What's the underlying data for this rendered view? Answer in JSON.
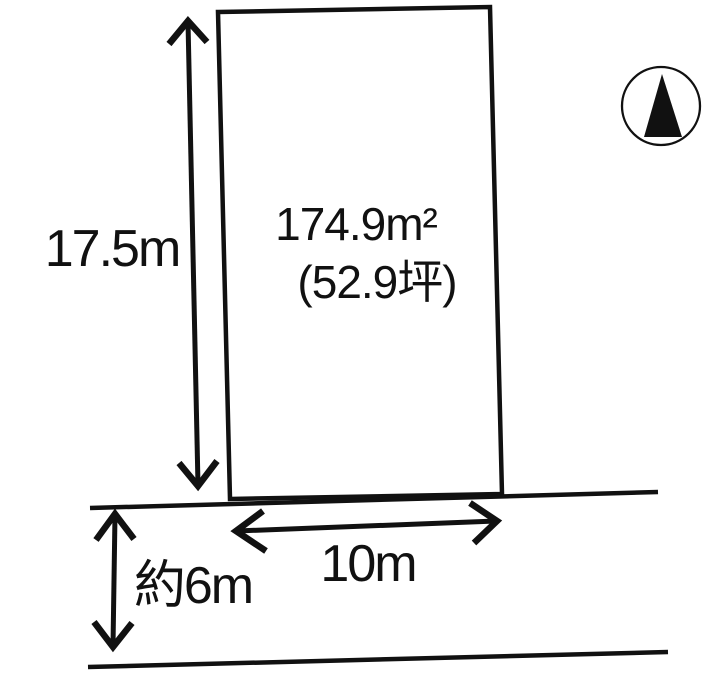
{
  "diagram": {
    "type": "land-plot-site-plan",
    "plot": {
      "area_sqm": "174.9m²",
      "area_tsubo": "(52.9坪)"
    },
    "dimensions": {
      "depth": "17.5m",
      "frontage": "10m",
      "road_width": "約6m"
    },
    "compass": {
      "icon": "north-arrow-icon",
      "direction": "north"
    },
    "colors": {
      "line": "#111111",
      "background": "#ffffff"
    }
  }
}
